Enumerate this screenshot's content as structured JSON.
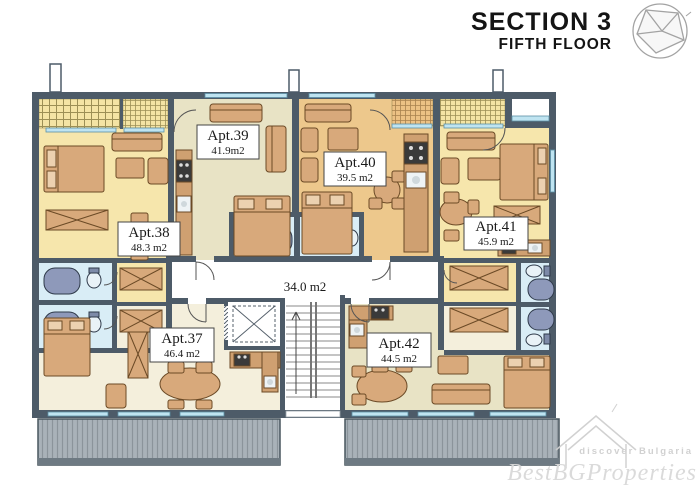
{
  "header": {
    "title": "SECTION 3",
    "subtitle": "FIFTH FLOOR"
  },
  "plan": {
    "corridor": {
      "area": "34.0 m2"
    },
    "apartments": [
      {
        "id": "apt37",
        "name": "Apt.37",
        "area": "46.4 m2"
      },
      {
        "id": "apt38",
        "name": "Apt.38",
        "area": "48.3 m2"
      },
      {
        "id": "apt39",
        "name": "Apt.39",
        "area": "41.9m2"
      },
      {
        "id": "apt40",
        "name": "Apt.40",
        "area": "39.5 m2"
      },
      {
        "id": "apt41",
        "name": "Apt.41",
        "area": "45.9 m2"
      },
      {
        "id": "apt42",
        "name": "Apt.42",
        "area": "44.5 m2"
      }
    ]
  },
  "watermark": {
    "tagline": "discover Bulgaria",
    "brand": "BestBGProperties"
  },
  "colors": {
    "wall": "#4d5b68",
    "window": "#bfe4f1",
    "room_yellow": "#f6e6ac",
    "room_olive": "#e8e3c5",
    "room_orange": "#edc88c",
    "room_cream": "#f4efdc",
    "bath_blue": "#d9edf6",
    "tub": "#8e99ba",
    "terrace": "#a9b2b9",
    "furniture": "#d8a97b",
    "furniture_dark": "#6b4a26",
    "ink": "#1a1a1a",
    "watermark_gray": "#d6d6d6"
  }
}
